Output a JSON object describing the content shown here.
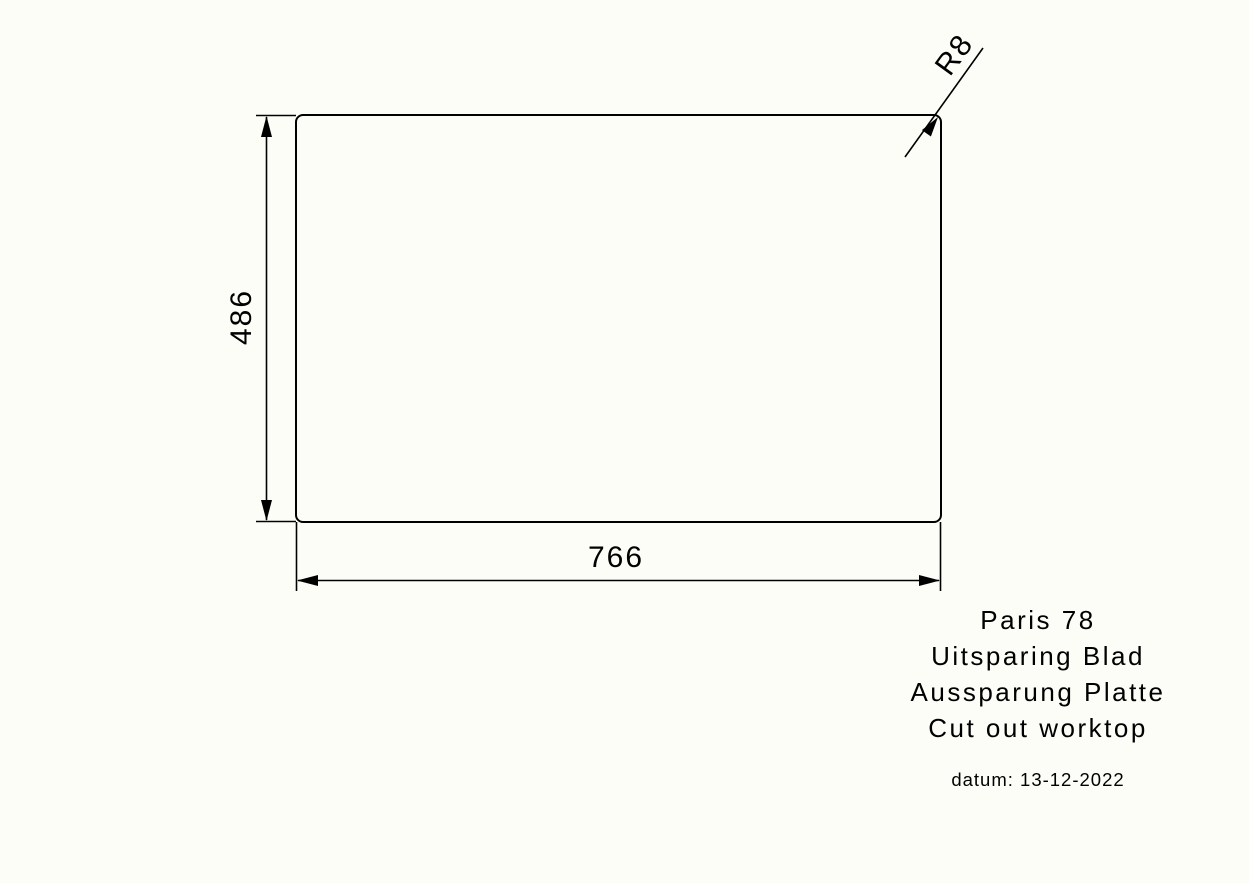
{
  "drawing": {
    "dimensions": {
      "height_label": "486",
      "width_label": "766",
      "radius_label": "R8"
    },
    "title_block": {
      "lines": [
        "Paris 78",
        "Uitsparing Blad",
        "Aussparung Platte",
        "Cut out worktop"
      ],
      "date_label": "datum: 13-12-2022"
    },
    "colors": {
      "line_color": "#000000",
      "background": "#FDFDF8"
    }
  }
}
